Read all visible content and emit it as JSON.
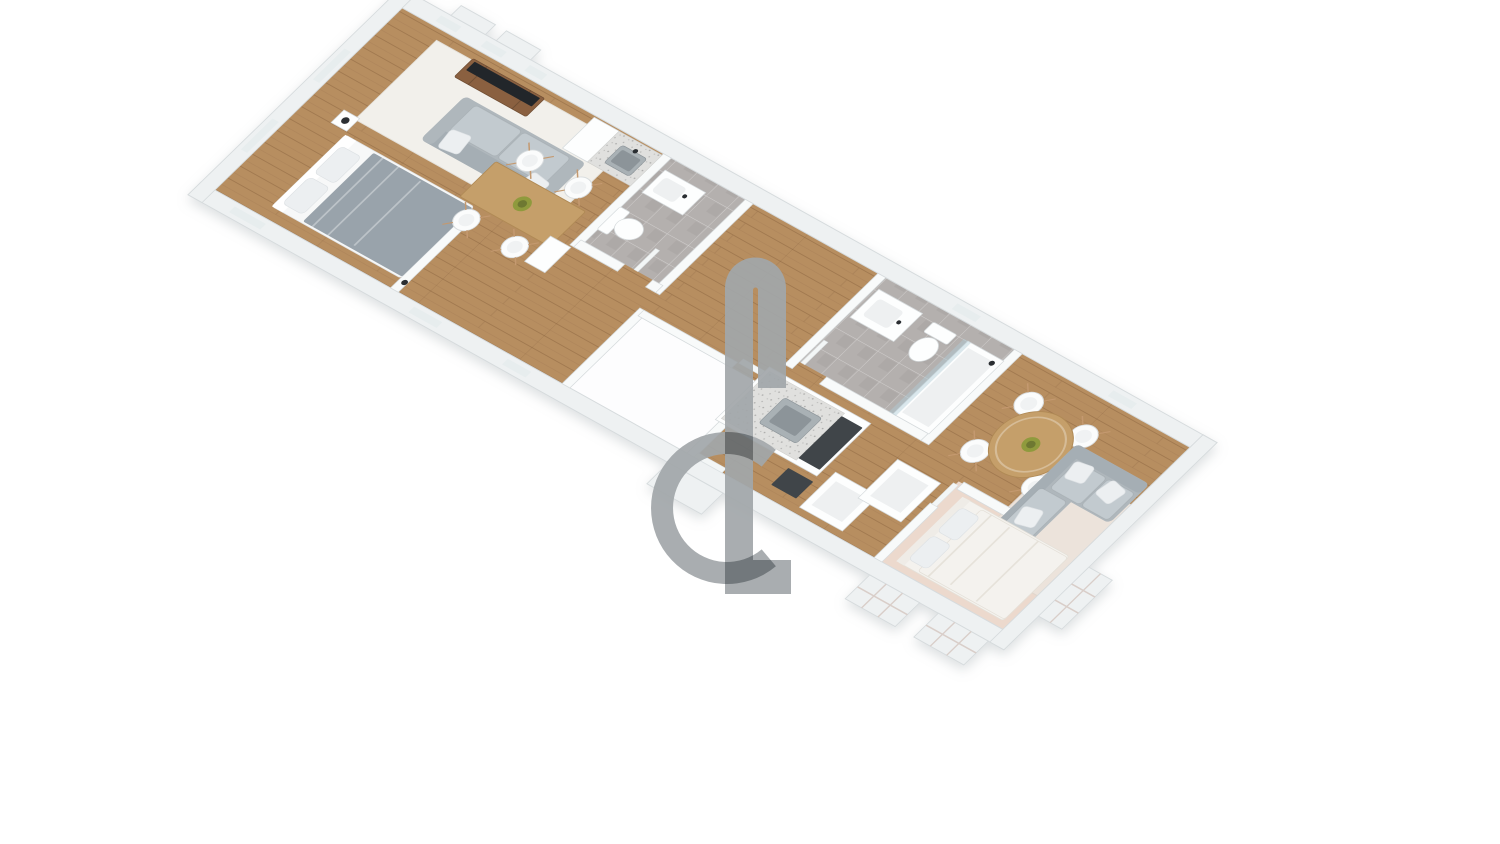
{
  "meta": {
    "kind": "3d-isometric-floor-plan-render",
    "background": "#ffffff",
    "visible_text": []
  },
  "palette": {
    "wood": "#b78e61",
    "tile": "#b4b0ae",
    "carpet": "#ecd9cd",
    "rug_white": "#f2f0eb",
    "rug_cream": "#ece3db",
    "white_room": "#fdfdfe",
    "wall_ext": "#eef1f2",
    "wall_int": "#f8fafa",
    "wall_edge": "#d6dbdd",
    "slit": "#e7edee",
    "sofa": "#afb7bc",
    "sofa_back": "#a5aeb4",
    "cushion": "#c2cacf",
    "pillow": "#eceff1",
    "blanket": "#99a3ab",
    "bed_sheet": "#f7f8f8",
    "bed2": "#f4f2ee",
    "wood_dark": "#8a6140",
    "table": "#c59f6b",
    "tv": "#23272c",
    "steel": "#a9b1b5",
    "steel_dark": "#8c9499",
    "counter": "#e0e0de",
    "appliance": "#3f4549",
    "glass": "#b0cdd6",
    "olive": "#8f9a3e",
    "olive_dark": "#6e7830",
    "lamp": "#2b2e31",
    "door": "#f3f6f6",
    "bay_line": "#d9cec9",
    "watermark": "#a2a7aa"
  },
  "watermark": {
    "shape": "semi-transparent C-ring with double vertical bar hooked at top and footed at bottom",
    "color": "#a2a7aa",
    "opacity": 0.92,
    "blend": "multiply"
  },
  "scene": {
    "style": "white walls, oak floor, elongated apartment strip viewed in rotated axonometric 3D",
    "rooms": [
      {
        "name": "bedroom-left",
        "floor": "wood",
        "furniture": [
          "double-bed-gray-blanket",
          "nightstand",
          "black-lamp"
        ]
      },
      {
        "name": "living-left",
        "floor": "wood + white rug",
        "furniture": [
          "tv-stand-wood",
          "tv-black",
          "sofa-gray",
          "dining-table-rect-wood",
          "white-chairs-4",
          "plant-bowl"
        ]
      },
      {
        "name": "kitchen-left",
        "floor": "wood",
        "furniture": [
          "tall-white-unit",
          "counter-speckled",
          "steel-sink"
        ]
      },
      {
        "name": "bathroom-left",
        "floor": "gray-tile",
        "furniture": [
          "vanity-sink",
          "toilet"
        ]
      },
      {
        "name": "hallway",
        "floor": "wood",
        "furniture": [
          "white-cabinet"
        ]
      },
      {
        "name": "white-empty-room",
        "floor": "white",
        "furniture": []
      },
      {
        "name": "bathroom-right",
        "floor": "gray-tile",
        "furniture": [
          "vanity-sink",
          "toilet",
          "glass-shower"
        ]
      },
      {
        "name": "kitchen-right",
        "floor": "wood",
        "furniture": [
          "island-counter-steel-sink",
          "dark-cooktop",
          "open-white-boxes-2"
        ]
      },
      {
        "name": "dining-right",
        "floor": "wood",
        "furniture": [
          "round-table-wood",
          "white-shell-chairs-4",
          "olive-bowl"
        ]
      },
      {
        "name": "living-right",
        "floor": "wood + cream rug",
        "furniture": [
          "corner-sofa-gray",
          "white-pillows"
        ]
      },
      {
        "name": "bedroom-right",
        "floor": "pink-beige carpet",
        "furniture": [
          "double-bed-white"
        ]
      }
    ],
    "exterior": [
      "window-bumpouts-top-left-2",
      "entrance-porch-bottom",
      "gridded-window-bays-bottom-right-2",
      "gridded-window-bay-right-end"
    ]
  }
}
